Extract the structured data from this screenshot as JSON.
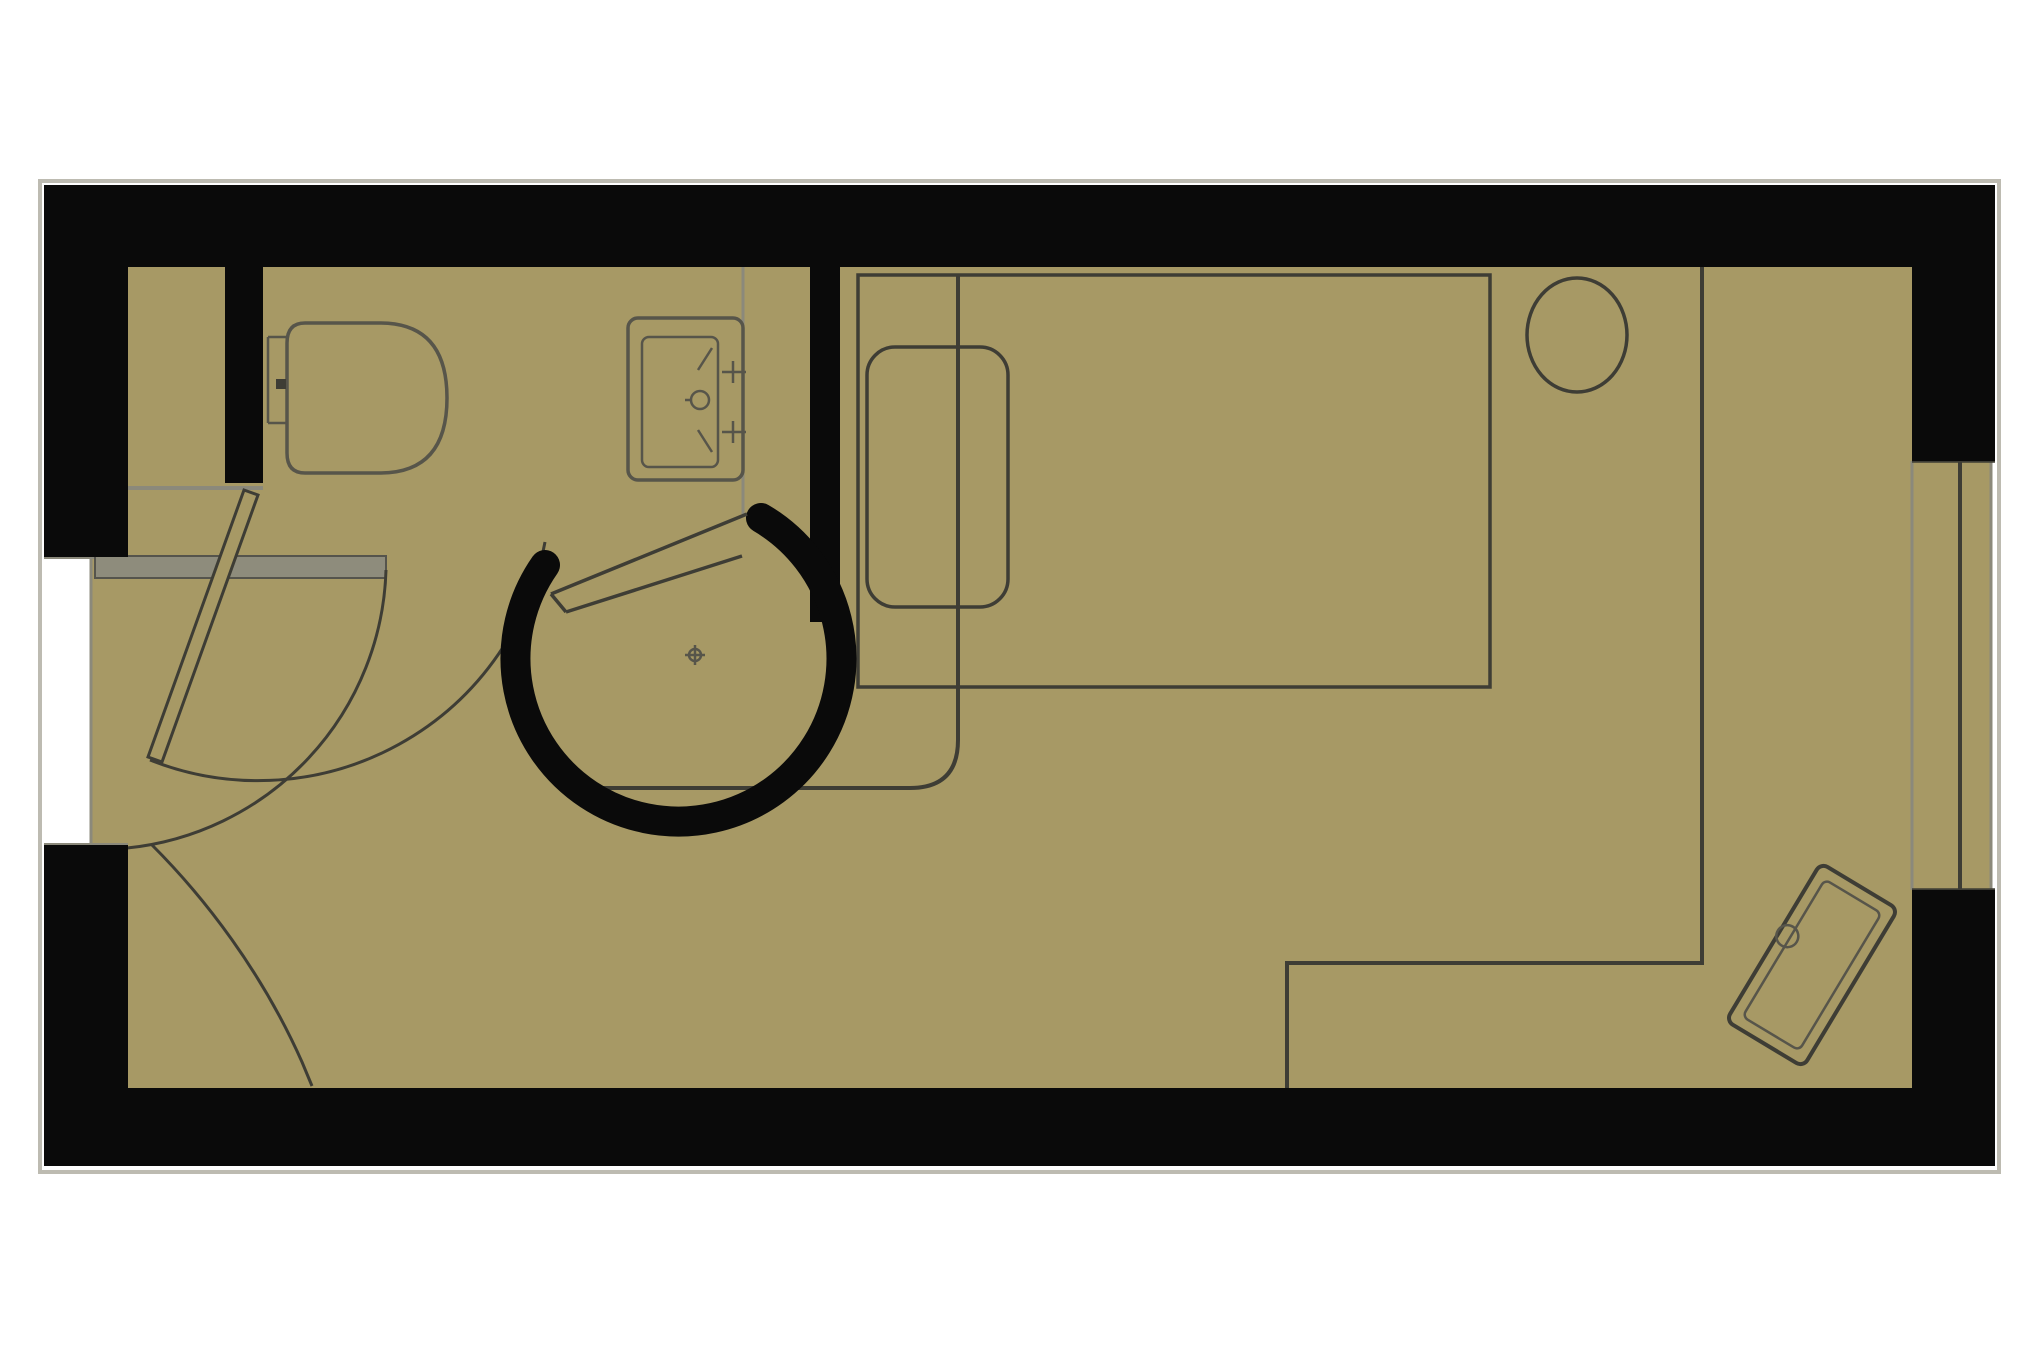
{
  "document": {
    "type": "floor-plan",
    "description": "Top-down architectural floor plan of a studio hotel room with en-suite bathroom, single key plan drawing, no text labels"
  },
  "colors": {
    "bg": "#ffffff",
    "floor": "#a79965",
    "wall": "#0a0a0a",
    "line_dark": "#3e3d35",
    "line_mid": "#57554a",
    "line_light": "#8b897b",
    "outline": "#bdbbb1",
    "leaf": "#8e8c7c",
    "leaf_edge": "#55544c"
  },
  "plan": {
    "rooms": [
      {
        "name": "bathroom",
        "position": "top-left"
      },
      {
        "name": "bedroom",
        "position": "right"
      },
      {
        "name": "entry-vestibule",
        "position": "bottom-left"
      }
    ],
    "fixtures": [
      {
        "name": "toilet",
        "room": "bathroom"
      },
      {
        "name": "vanity-sink",
        "room": "bathroom"
      },
      {
        "name": "shower-pod",
        "room": "bathroom"
      },
      {
        "name": "bathroom-door",
        "room": "bathroom",
        "state": "shown-with-swing-arc"
      },
      {
        "name": "entry-door",
        "room": "entry-vestibule",
        "state": "shown-open-with-swing-arc"
      },
      {
        "name": "bed",
        "room": "bedroom"
      },
      {
        "name": "pillow",
        "room": "bedroom"
      },
      {
        "name": "round-table",
        "room": "bedroom"
      },
      {
        "name": "window-bay",
        "room": "bedroom",
        "wall": "right"
      },
      {
        "name": "luggage-bench",
        "room": "bedroom",
        "position": "bottom-right",
        "rotation_deg": 31
      },
      {
        "name": "closet-desk-line",
        "room": "bedroom",
        "position": "bottom-right"
      }
    ]
  }
}
